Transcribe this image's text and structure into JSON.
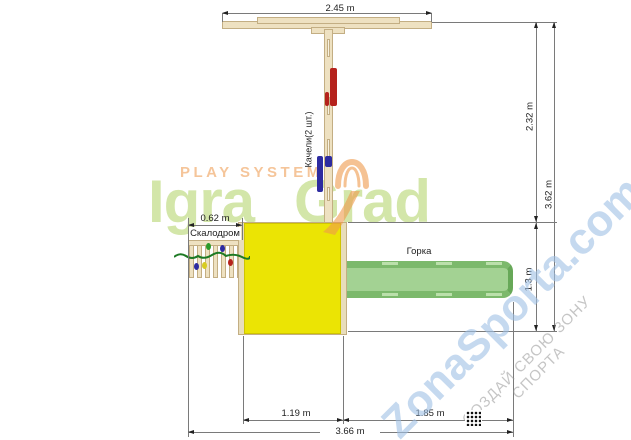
{
  "watermarks": {
    "tagline": "PLAY SYSTEM",
    "brand_part1": "Igra",
    "brand_part2": "Grad",
    "site": "ZonaSporta.com",
    "slogan": "СОЗДАЙ СВОЮ ЗОНУ СПОРТА"
  },
  "part_labels": {
    "swings": "Качели(2 шт.)",
    "climbing_wall": "Скалодром",
    "slide": "Горка"
  },
  "dimensions": {
    "crossbeam_width": "2.45 m",
    "swing_zone_depth": "2.32 m",
    "overall_depth": "3.62 m",
    "platform_depth": "1.3 m",
    "climbing_wall_width": "0.62 m",
    "platform_width": "1.19 m",
    "slide_length": "1.85 m",
    "overall_width": "3.66 m"
  },
  "colors": {
    "wood": "#eee1c1",
    "wood_border": "#c3ae83",
    "platform_yellow": "#ebe404",
    "slide_green": "#a3d293",
    "slide_green_dark": "#7cb96c",
    "swing_seat_red": "#b5221c",
    "swing_seat_blue": "#2d2ba0",
    "climb_hold_green": "#2a9a2a",
    "climb_hold_yellow": "#d8cc20",
    "watermark_green": "#a7ce54",
    "watermark_orange": "#f2a961",
    "watermark_blue": "#9ec0e4",
    "dimension_line": "#7a7a7a"
  }
}
